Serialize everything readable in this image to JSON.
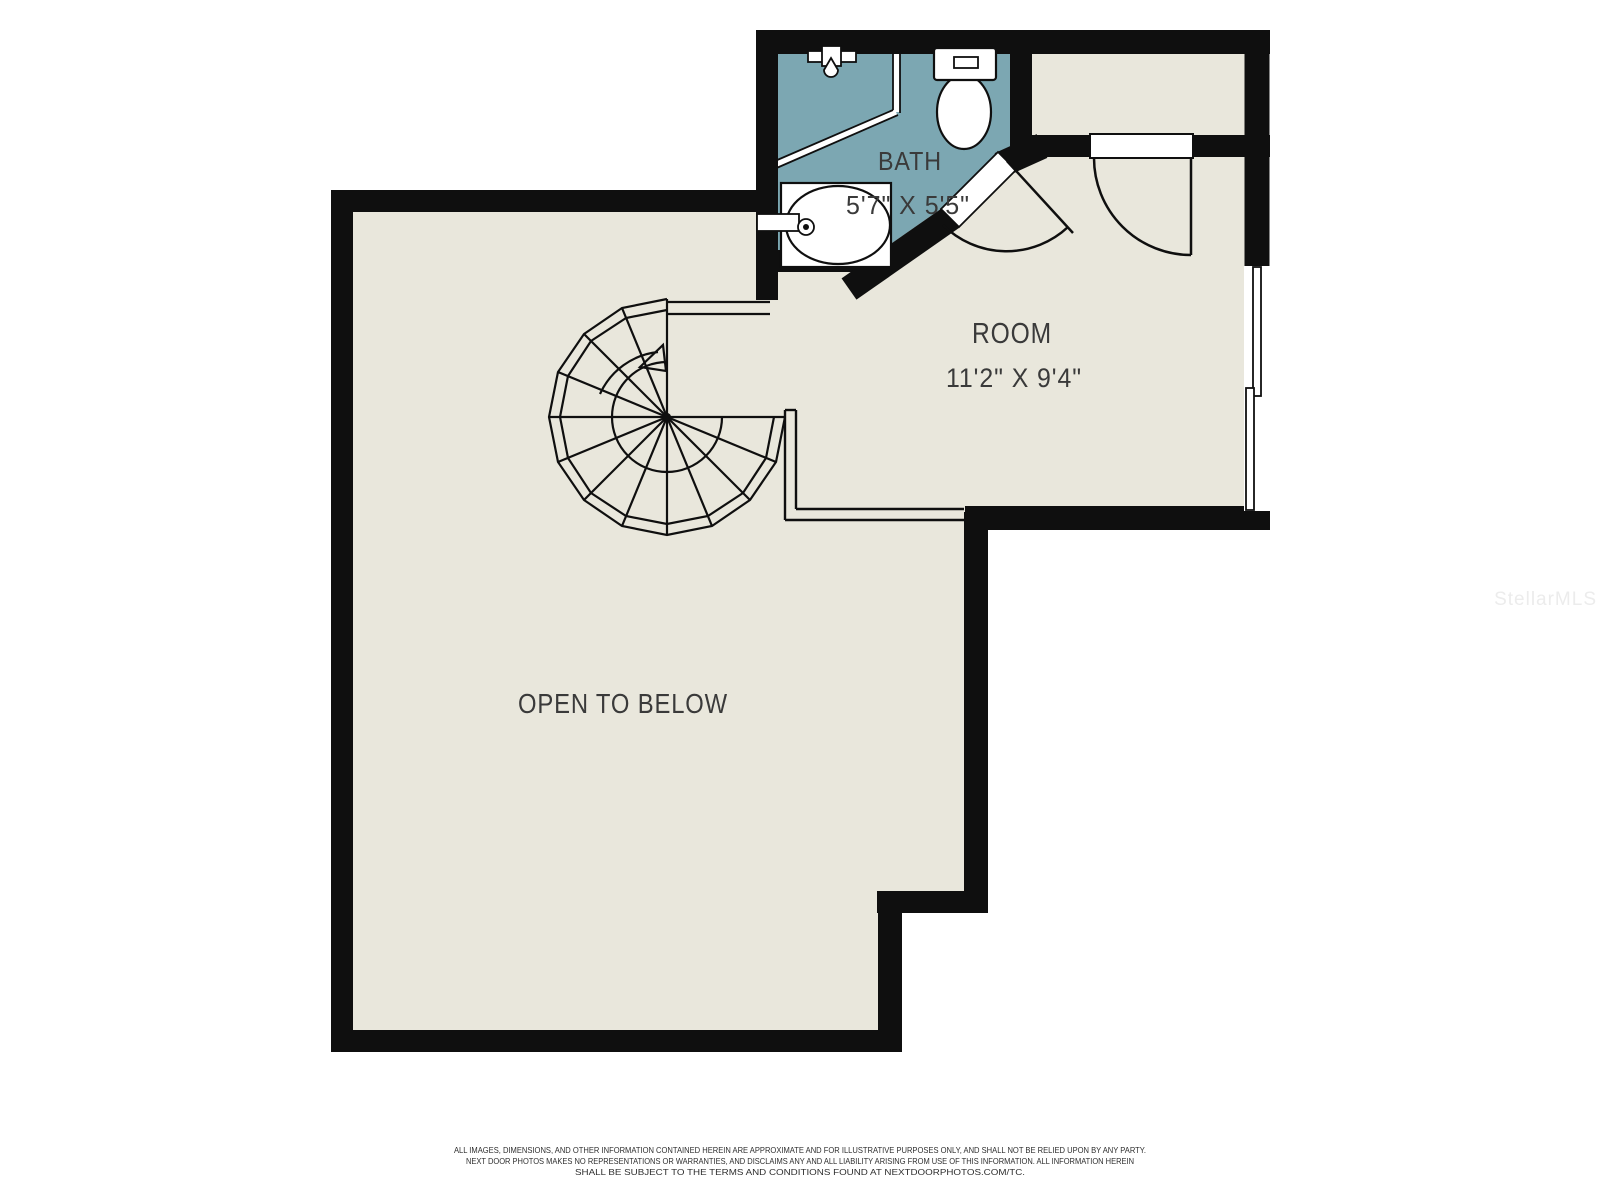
{
  "floor_plan": {
    "rooms": {
      "bath": {
        "label": "BATH",
        "dimensions": "5'7\" X 5'5\""
      },
      "room": {
        "label": "ROOM",
        "dimensions": "11'2\" X 9'4\""
      },
      "open_to_below": {
        "label": "OPEN TO BELOW"
      }
    },
    "features": [
      "spiral-staircase",
      "shower",
      "toilet",
      "sink",
      "double-hung-window",
      "swing-doors",
      "railing",
      "closet"
    ],
    "colors": {
      "background": "#ffffff",
      "floor": "#e9e7dc",
      "bath_floor": "#7ca7b2",
      "wall": "#0f0f0f",
      "fixture": "#ffffff",
      "text": "#3a3a3a",
      "watermark": "#ececec"
    }
  },
  "watermark": {
    "text": "StellarMLS"
  },
  "disclaimer": {
    "line1": "ALL IMAGES, DIMENSIONS, AND OTHER INFORMATION CONTAINED HEREIN ARE APPROXIMATE AND FOR ILLUSTRATIVE PURPOSES ONLY, AND SHALL NOT BE RELIED UPON BY ANY PARTY.",
    "line2": "NEXT DOOR PHOTOS MAKES NO REPRESENTATIONS OR WARRANTIES, AND DISCLAIMS ANY AND ALL LIABILITY ARISING FROM USE OF THIS INFORMATION. ALL INFORMATION HEREIN",
    "line3": "SHALL BE SUBJECT TO THE TERMS AND CONDITIONS FOUND AT NEXTDOORPHOTOS.COM/TC."
  }
}
